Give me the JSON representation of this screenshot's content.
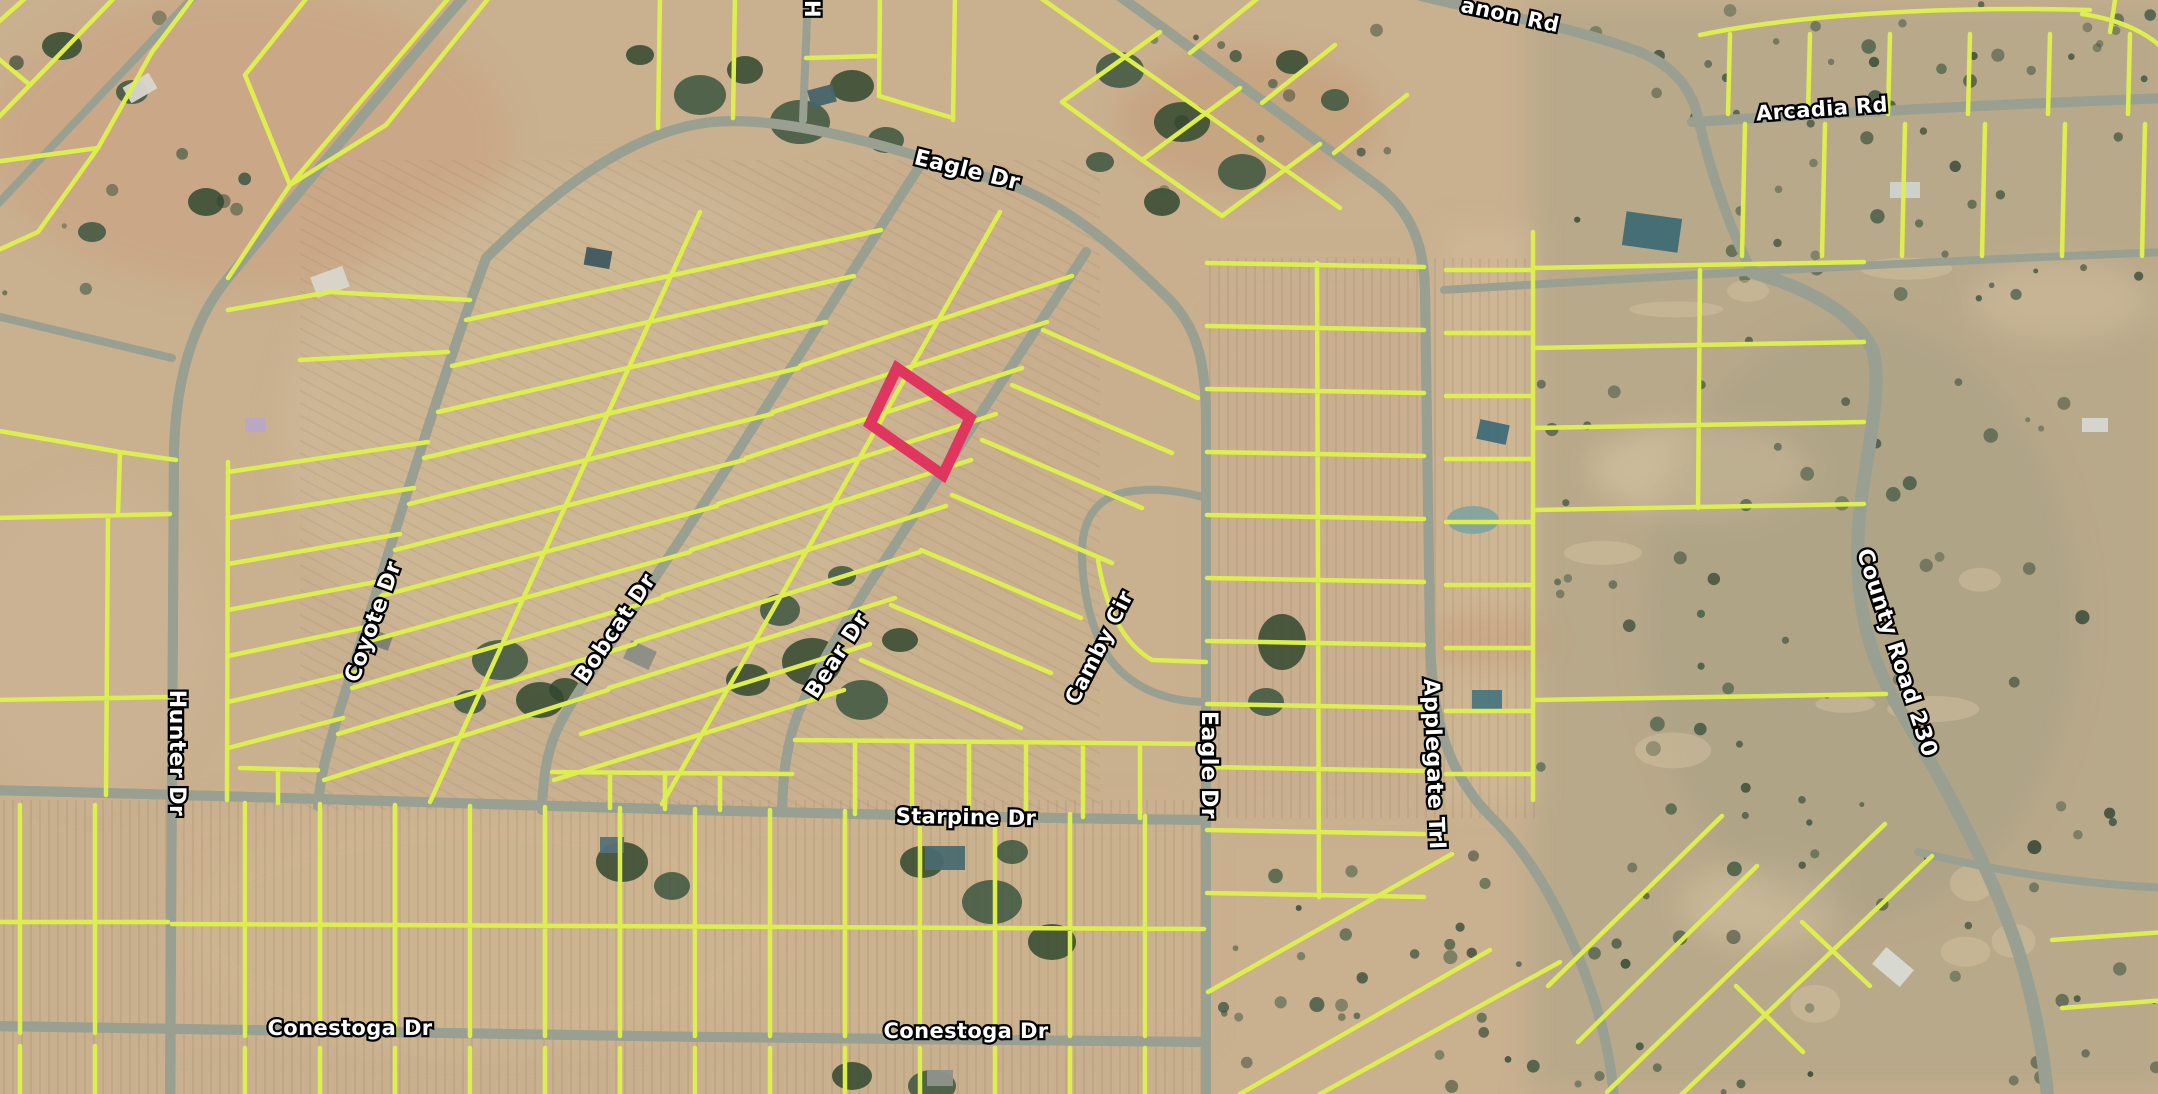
{
  "map": {
    "view": "satellite-parcel-map",
    "colors": {
      "parcel_line": "#ddef4e",
      "selected_parcel": "#e0355f",
      "road": "#9aa091",
      "label_text": "#ffffff",
      "label_outline": "#000000"
    },
    "labels": [
      {
        "id": "anon-rd",
        "text": "anon Rd"
      },
      {
        "id": "arcadia-rd",
        "text": "Arcadia Rd"
      },
      {
        "id": "h-partial",
        "text": "H"
      },
      {
        "id": "eagle-dr-top",
        "text": "Eagle Dr"
      },
      {
        "id": "coyote-dr",
        "text": "Coyote Dr"
      },
      {
        "id": "bobcat-dr",
        "text": "Bobcat Dr"
      },
      {
        "id": "bear-dr",
        "text": "Bear Dr"
      },
      {
        "id": "camby-cir",
        "text": "Camby Cir"
      },
      {
        "id": "eagle-dr-vertical",
        "text": "Eagle Dr"
      },
      {
        "id": "applegate-trl",
        "text": "Applegate Trl"
      },
      {
        "id": "county-road-230",
        "text": "County Road 230"
      },
      {
        "id": "hunter-dr",
        "text": "Hunter Dr"
      },
      {
        "id": "starpine-dr",
        "text": "Starpine Dr"
      },
      {
        "id": "conestoga-dr-west",
        "text": "Conestoga Dr"
      },
      {
        "id": "conestoga-dr-center",
        "text": "Conestoga Dr"
      }
    ]
  }
}
